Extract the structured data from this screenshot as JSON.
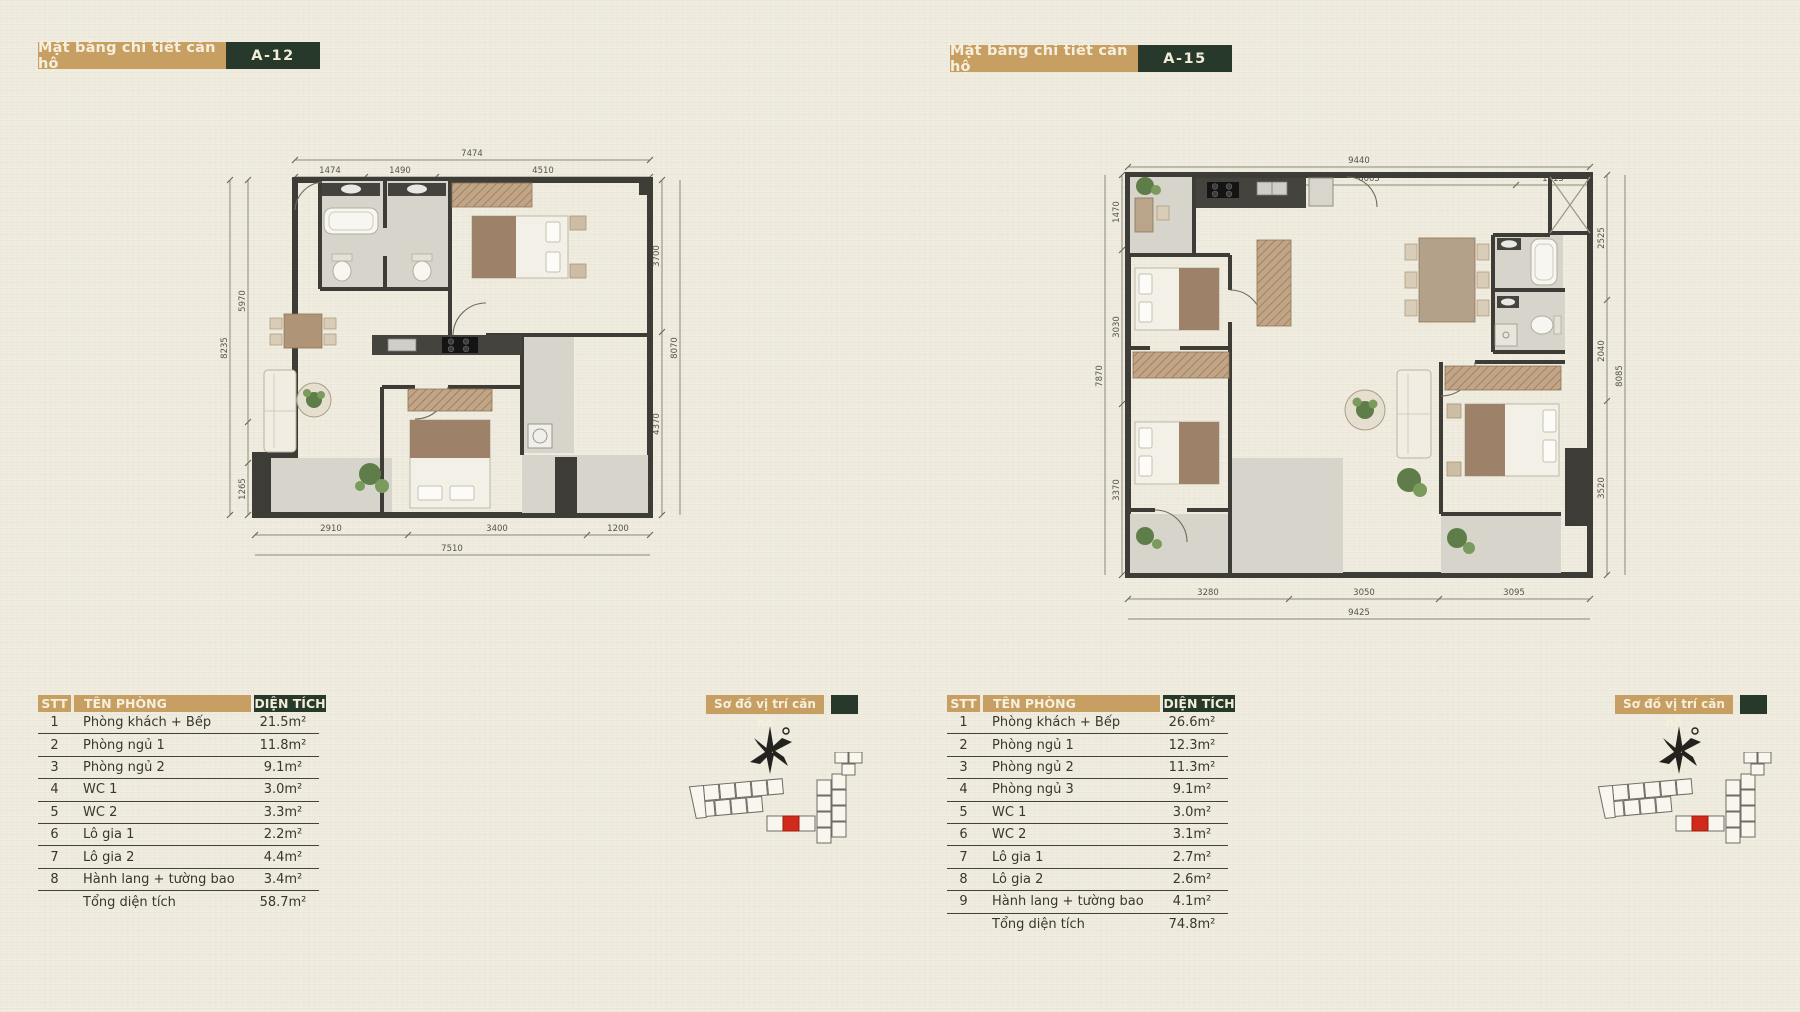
{
  "colors": {
    "tan": "#c79f62",
    "dark_green": "#27392a",
    "paper": "#f1eee2",
    "wall": "#3e3c37",
    "red_unit": "#cf2a1a"
  },
  "units": [
    {
      "code": "A-12",
      "header_label": "Mặt bằng chi tiết căn hộ",
      "location_label": "Sơ đồ vị trí căn hộ",
      "dims": {
        "top": {
          "overall": "7474",
          "segments": [
            "1474",
            "1490",
            "4510"
          ]
        },
        "left": {
          "overall": "8235",
          "segments": [
            "5970",
            "1265"
          ]
        },
        "right": {
          "overall": "8070",
          "segments": [
            "3700",
            "4370"
          ]
        },
        "bottom": {
          "overall": "7510",
          "segments": [
            "2910",
            "3400",
            "1200"
          ]
        }
      },
      "table": {
        "headers": [
          "STT",
          "TÊN PHÒNG",
          "DIỆN TÍCH"
        ],
        "rows": [
          {
            "stt": "1",
            "name": "Phòng khách + Bếp",
            "area": "21.5m²"
          },
          {
            "stt": "2",
            "name": "Phòng ngủ 1",
            "area": "11.8m²"
          },
          {
            "stt": "3",
            "name": "Phòng ngủ 2",
            "area": "9.1m²"
          },
          {
            "stt": "4",
            "name": "WC 1",
            "area": "3.0m²"
          },
          {
            "stt": "5",
            "name": "WC 2",
            "area": "3.3m²"
          },
          {
            "stt": "6",
            "name": "Lô gia 1",
            "area": "2.2m²"
          },
          {
            "stt": "7",
            "name": "Lô gia 2",
            "area": "4.4m²"
          },
          {
            "stt": "8",
            "name": "Hành lang + tường bao",
            "area": "3.4m²"
          }
        ],
        "total_label": "Tổng diện tích",
        "total_area": "58.7m²"
      }
    },
    {
      "code": "A-15",
      "header_label": "Mặt bằng chi tiết căn hộ",
      "location_label": "Sơ đồ vị trí căn hộ",
      "dims": {
        "top": {
          "overall": "9440",
          "segments": [
            "1920",
            "6005",
            "1515"
          ]
        },
        "left": {
          "overall": "7870",
          "segments": [
            "1470",
            "3030",
            "3370"
          ]
        },
        "right": {
          "overall": "8085",
          "segments": [
            "2525",
            "2040",
            "3520"
          ]
        },
        "bottom": {
          "overall": "9425",
          "segments": [
            "3280",
            "3050",
            "3095"
          ]
        }
      },
      "table": {
        "headers": [
          "STT",
          "TÊN PHÒNG",
          "DIỆN TÍCH"
        ],
        "rows": [
          {
            "stt": "1",
            "name": "Phòng khách + Bếp",
            "area": "26.6m²"
          },
          {
            "stt": "2",
            "name": "Phòng ngủ 1",
            "area": "12.3m²"
          },
          {
            "stt": "3",
            "name": "Phòng ngủ 2",
            "area": "11.3m²"
          },
          {
            "stt": "4",
            "name": "Phòng ngủ 3",
            "area": "9.1m²"
          },
          {
            "stt": "5",
            "name": "WC 1",
            "area": "3.0m²"
          },
          {
            "stt": "6",
            "name": "WC 2",
            "area": "3.1m²"
          },
          {
            "stt": "7",
            "name": "Lô gia 1",
            "area": "2.7m²"
          },
          {
            "stt": "8",
            "name": "Lô gia 2",
            "area": "2.6m²"
          },
          {
            "stt": "9",
            "name": "Hành lang + tường bao",
            "area": "4.1m²"
          }
        ],
        "total_label": "Tổng diện tích",
        "total_area": "74.8m²"
      }
    }
  ]
}
